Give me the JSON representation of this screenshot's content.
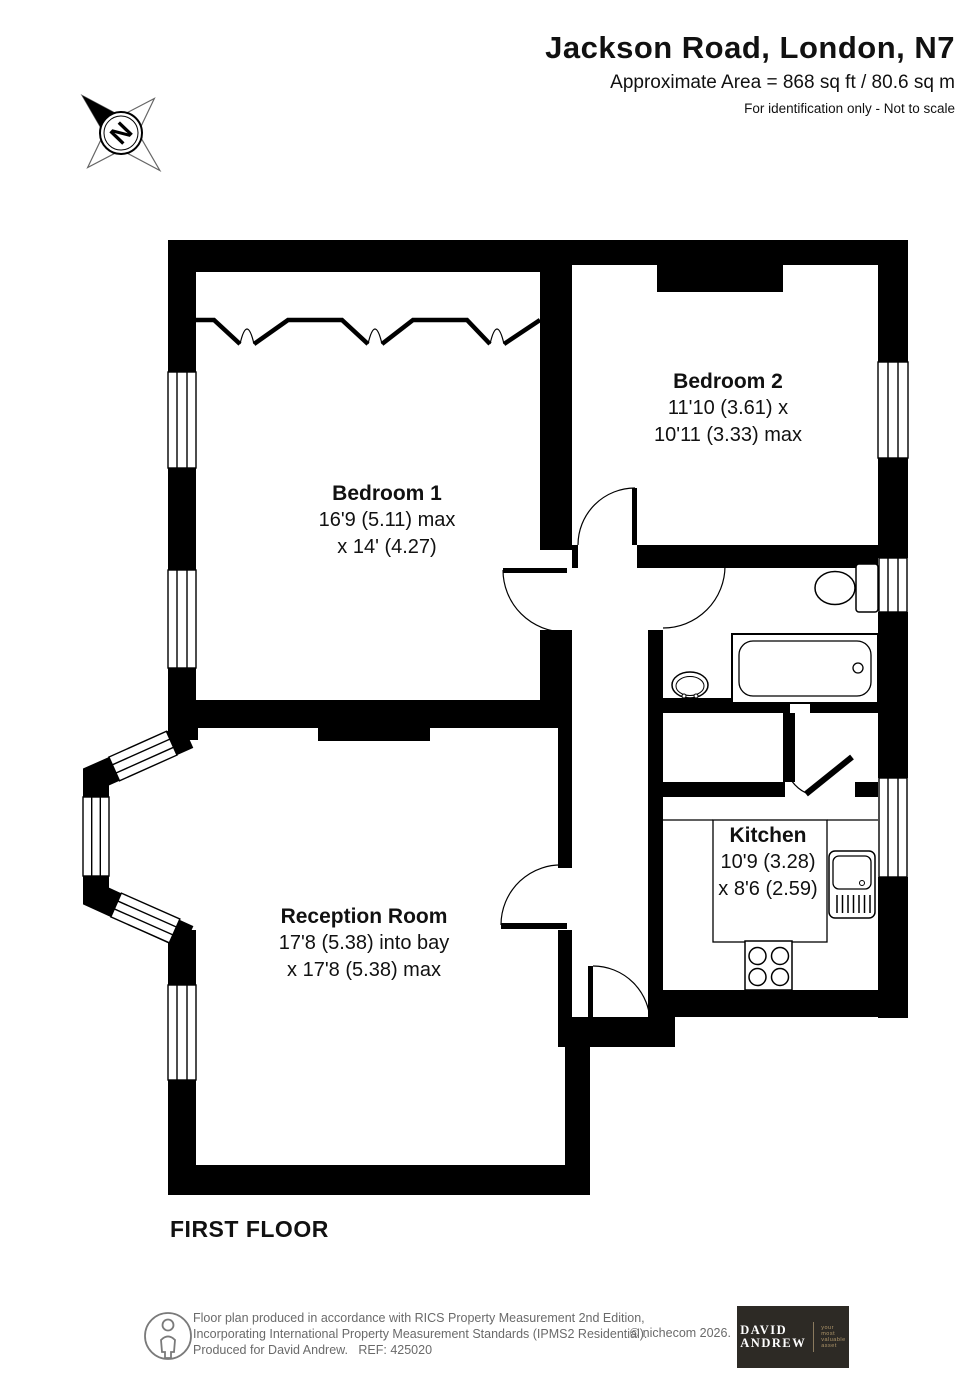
{
  "header": {
    "title": "Jackson Road, London, N7",
    "area_line": "Approximate Area = 868 sq ft / 80.6 sq m",
    "disclaimer": "For identification only - Not to scale"
  },
  "compass": {
    "letter": "N"
  },
  "floor_label": "FIRST FLOOR",
  "rooms": [
    {
      "name": "Bedroom 1",
      "dim1": "16'9 (5.11) max",
      "dim2": "x 14' (4.27)"
    },
    {
      "name": "Bedroom 2",
      "dim1": "11'10 (3.61) x",
      "dim2": "10'11 (3.33) max"
    },
    {
      "name": "Reception Room",
      "dim1": "17'8 (5.38) into bay",
      "dim2": "x 17'8 (5.38) max"
    },
    {
      "name": "Kitchen",
      "dim1": "10'9 (3.28)",
      "dim2": "x 8'6 (2.59)"
    }
  ],
  "footer": {
    "line1": "Floor plan produced in accordance with RICS Property Measurement 2nd Edition,",
    "line2": "Incorporating International Property Measurement Standards (IPMS2 Residential).",
    "line3": "Produced for David Andrew.   REF: 425020",
    "copyright": "© nichecom 2026.",
    "logo": {
      "name": "DAVID\nANDREW",
      "tagline": "your\nmost\nvaluable\nasset",
      "bg_color": "#2d2a25",
      "tagline_color": "#b0976b"
    }
  },
  "colors": {
    "wall": "#000000",
    "text": "#111111",
    "footer_text": "#6a6a6a"
  }
}
